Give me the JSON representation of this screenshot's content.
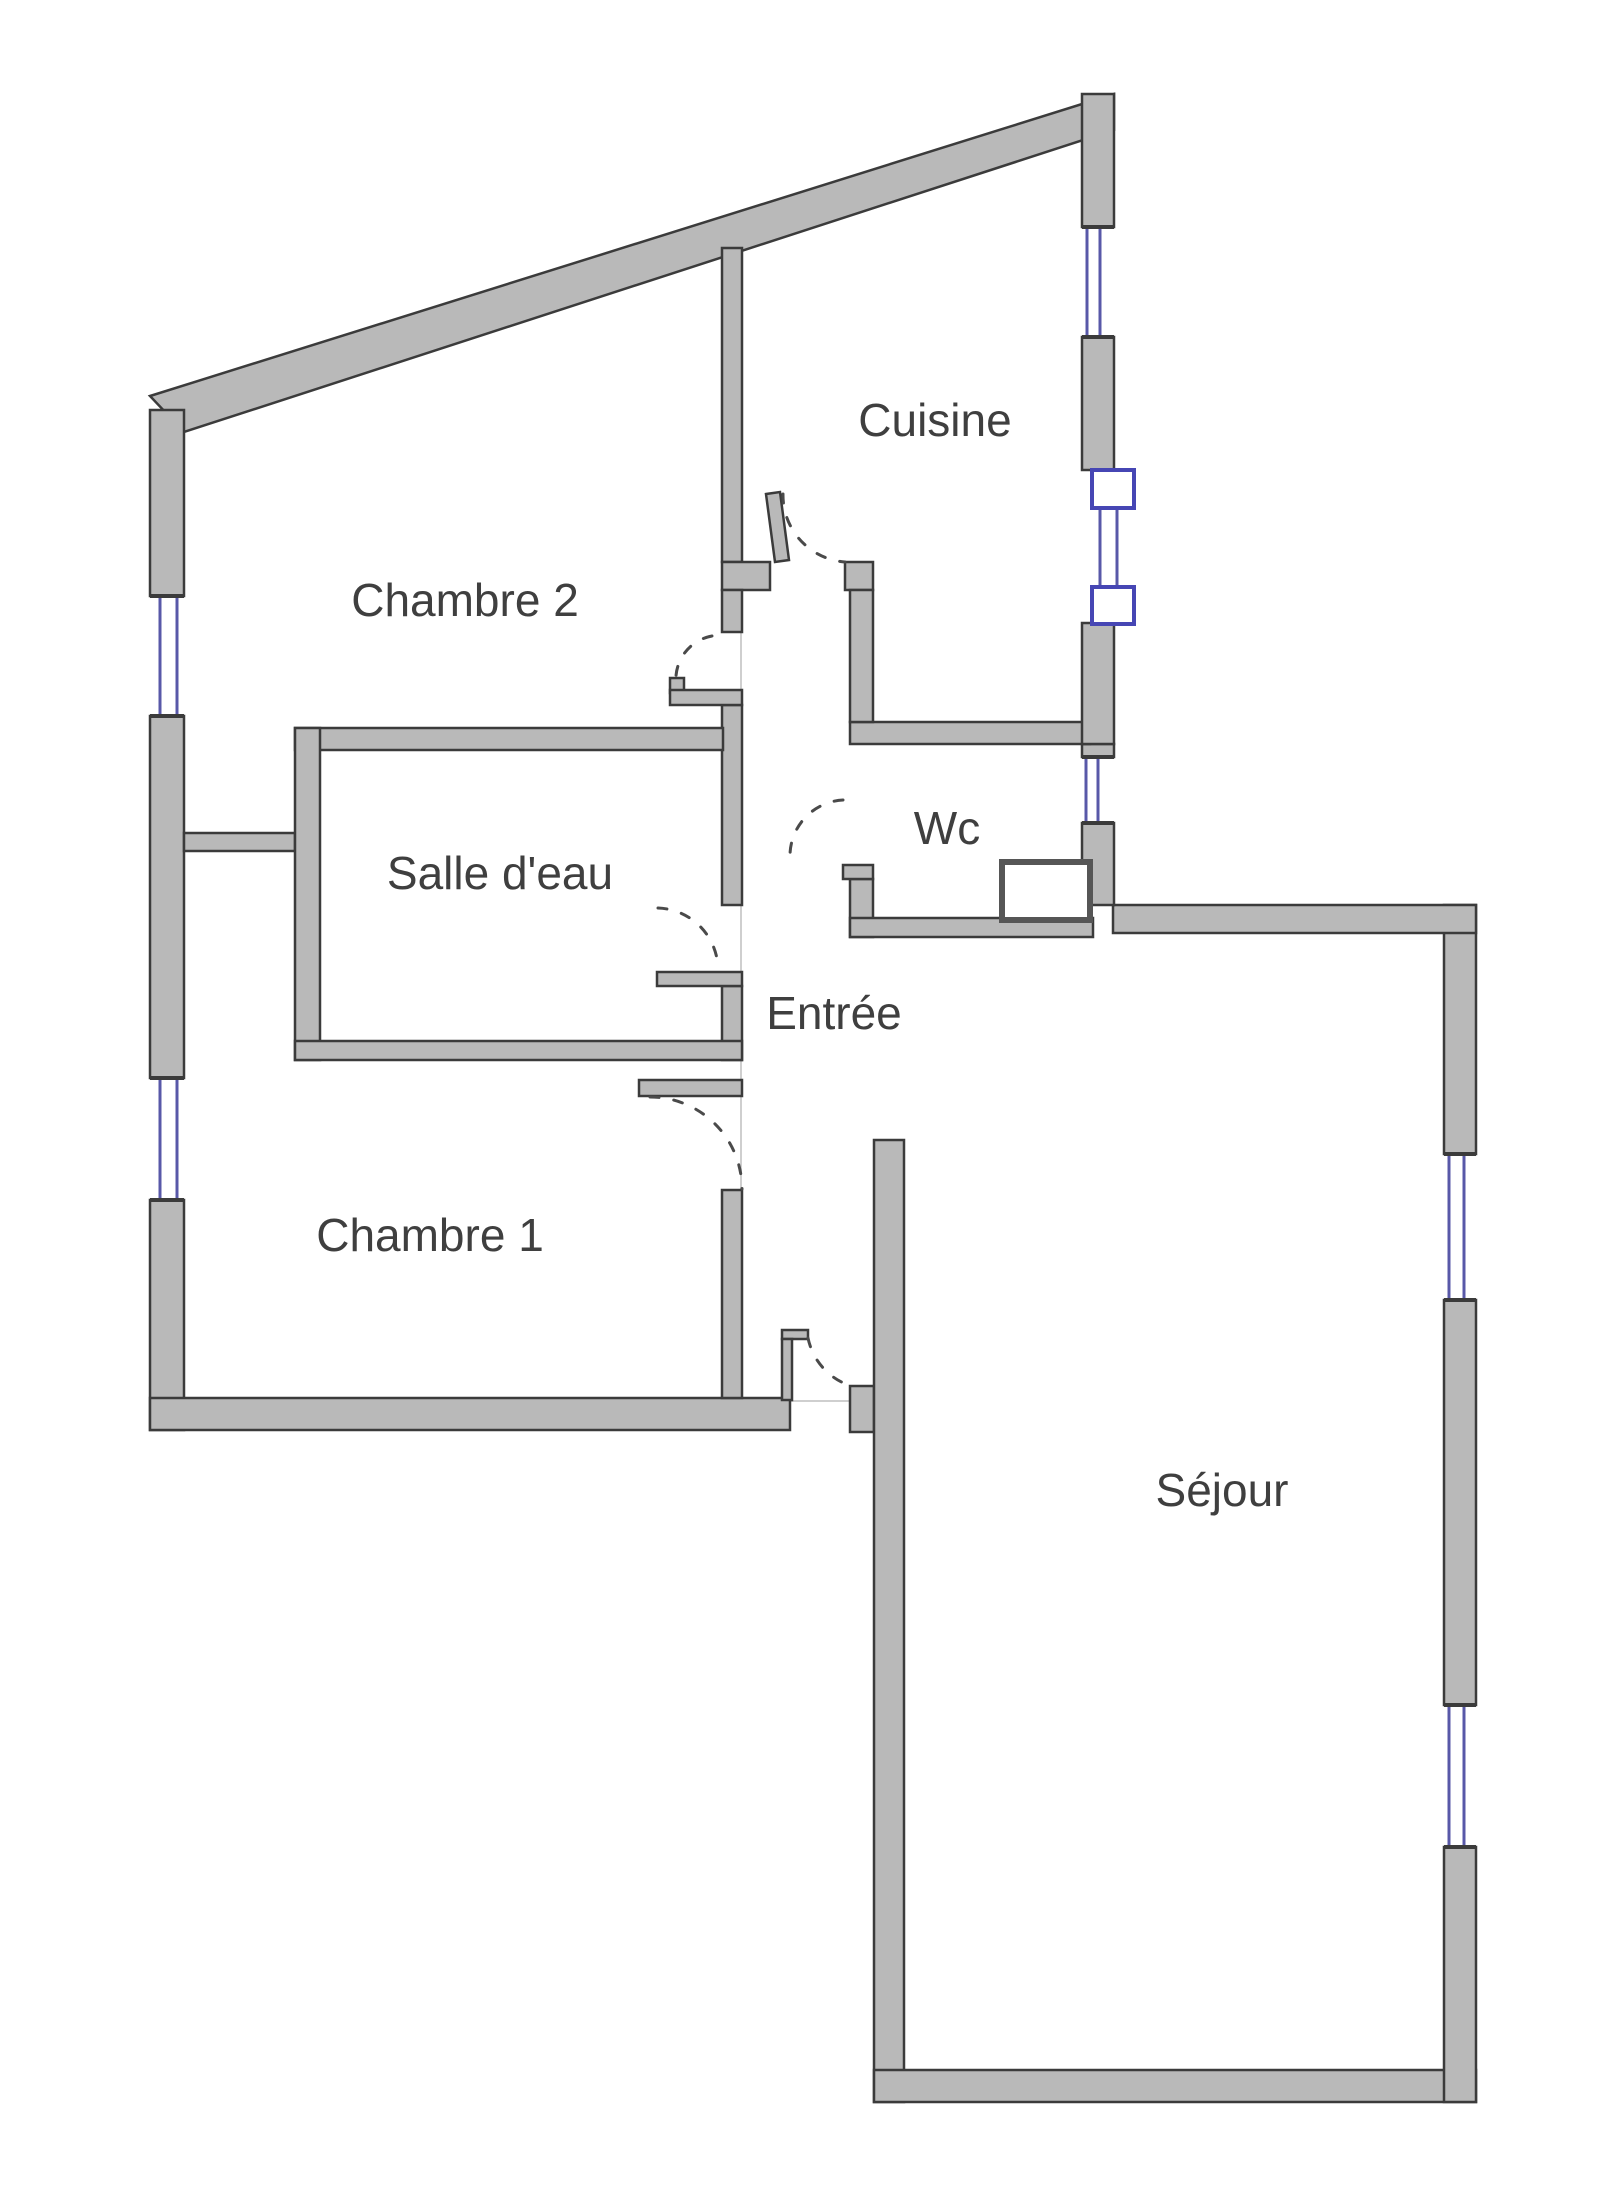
{
  "plan": {
    "width": 1600,
    "height": 2210,
    "kind": "apartment-floor-plan"
  },
  "colors": {
    "bg": "#ffffff",
    "wall_fill": "#b9b9b9",
    "wall_edge": "#3b3b3b",
    "window_blue": "#5858a8",
    "marker_blue": "#4646b4",
    "door_dash": "#4a4a4a",
    "face_line": "#cfcfcf",
    "label": "#3f3f3f"
  },
  "rooms": [
    {
      "id": "chambre2",
      "label": "Chambre 2",
      "x": 465,
      "y": 616
    },
    {
      "id": "cuisine",
      "label": "Cuisine",
      "x": 935,
      "y": 436
    },
    {
      "id": "salledeau",
      "label": "Salle d'eau",
      "x": 500,
      "y": 889
    },
    {
      "id": "wc",
      "label": "Wc",
      "x": 947,
      "y": 844
    },
    {
      "id": "entree",
      "label": "Entrée",
      "x": 834,
      "y": 1029
    },
    {
      "id": "chambre1",
      "label": "Chambre 1",
      "x": 430,
      "y": 1251
    },
    {
      "id": "sejour",
      "label": "Séjour",
      "x": 1222,
      "y": 1506
    }
  ],
  "geometry": {
    "walls_poly": [
      {
        "name": "top-diagonal-wall",
        "pts": "150,396 1114,94 1114,130 184,432"
      },
      {
        "name": "kitchen-door-leaf",
        "pts": "766,494 780,492 789,560 775,562"
      }
    ],
    "walls": [
      {
        "name": "left-wall-upper",
        "x": 150,
        "y": 410,
        "w": 34,
        "h": 186
      },
      {
        "name": "left-wall-mid",
        "x": 150,
        "y": 716,
        "w": 34,
        "h": 362
      },
      {
        "name": "left-wall-lower",
        "x": 150,
        "y": 1200,
        "w": 34,
        "h": 230
      },
      {
        "name": "chambre1-bottom-wall",
        "x": 150,
        "y": 1398,
        "w": 640,
        "h": 32
      },
      {
        "name": "entry-jog-wall",
        "x": 850,
        "y": 1386,
        "w": 24,
        "h": 46
      },
      {
        "name": "sejour-left-wall",
        "x": 874,
        "y": 1140,
        "w": 30,
        "h": 962
      },
      {
        "name": "sejour-bottom-wall",
        "x": 874,
        "y": 2070,
        "w": 602,
        "h": 32
      },
      {
        "name": "sejour-right-wall-lower",
        "x": 1444,
        "y": 1847,
        "w": 32,
        "h": 255
      },
      {
        "name": "sejour-right-wall-mid",
        "x": 1444,
        "y": 1300,
        "w": 32,
        "h": 405
      },
      {
        "name": "sejour-right-wall-upper",
        "x": 1444,
        "y": 905,
        "w": 32,
        "h": 249
      },
      {
        "name": "sejour-top-wall",
        "x": 1113,
        "y": 905,
        "w": 363,
        "h": 28
      },
      {
        "name": "east-wall-below-wc-window",
        "x": 1082,
        "y": 823,
        "w": 32,
        "h": 82
      },
      {
        "name": "east-wall-above-wc-window",
        "x": 1082,
        "y": 744,
        "w": 32,
        "h": 13
      },
      {
        "name": "wc-top-wall",
        "x": 850,
        "y": 722,
        "w": 240,
        "h": 22
      },
      {
        "name": "east-wall-cuisine-lower",
        "x": 1082,
        "y": 623,
        "w": 32,
        "h": 121
      },
      {
        "name": "east-wall-cuisine-mid",
        "x": 1082,
        "y": 337,
        "w": 32,
        "h": 133
      },
      {
        "name": "east-wall-peak",
        "x": 1082,
        "y": 94,
        "w": 32,
        "h": 133
      },
      {
        "name": "divider-chambre2-cuisine",
        "x": 722,
        "y": 248,
        "w": 20,
        "h": 314
      },
      {
        "name": "cuisine-bottom-wall-left",
        "x": 722,
        "y": 562,
        "w": 48,
        "h": 28
      },
      {
        "name": "cuisine-bottom-wall-right",
        "x": 845,
        "y": 562,
        "w": 28,
        "h": 28
      },
      {
        "name": "corridor-west-wall-a",
        "x": 722,
        "y": 590,
        "w": 20,
        "h": 42
      },
      {
        "name": "corridor-west-wall-b",
        "x": 722,
        "y": 705,
        "w": 20,
        "h": 200
      },
      {
        "name": "corridor-west-wall-c",
        "x": 722,
        "y": 986,
        "w": 20,
        "h": 74
      },
      {
        "name": "corridor-west-wall-d",
        "x": 722,
        "y": 1190,
        "w": 20,
        "h": 208
      },
      {
        "name": "chambre2-strip-wall",
        "x": 184,
        "y": 833,
        "w": 111,
        "h": 18
      },
      {
        "name": "salledeau-top-wall",
        "x": 295,
        "y": 728,
        "w": 428,
        "h": 22
      },
      {
        "name": "salledeau-left-wall",
        "x": 295,
        "y": 728,
        "w": 25,
        "h": 332
      },
      {
        "name": "salledeau-bottom-wall",
        "x": 295,
        "y": 1041,
        "w": 447,
        "h": 19
      },
      {
        "name": "wc-left-wall-upper",
        "x": 850,
        "y": 590,
        "w": 23,
        "h": 132
      },
      {
        "name": "wc-left-wall-lower",
        "x": 850,
        "y": 879,
        "w": 23,
        "h": 58
      },
      {
        "name": "wc-bottom-wall",
        "x": 850,
        "y": 918,
        "w": 243,
        "h": 19
      }
    ],
    "leaves": [
      {
        "name": "chambre2-door-stub-up",
        "x": 670,
        "y": 678,
        "w": 14,
        "h": 15
      },
      {
        "name": "chambre2-door-stub",
        "x": 670,
        "y": 690,
        "w": 72,
        "h": 15
      },
      {
        "name": "salledeau-door-leaf",
        "x": 657,
        "y": 972,
        "w": 85,
        "h": 14
      },
      {
        "name": "chambre1-door-leaf",
        "x": 639,
        "y": 1080,
        "w": 103,
        "h": 16
      },
      {
        "name": "wc-door-stub",
        "x": 843,
        "y": 865,
        "w": 30,
        "h": 14
      },
      {
        "name": "entry-door-leaf-cap",
        "x": 782,
        "y": 1330,
        "w": 26,
        "h": 9
      },
      {
        "name": "entry-door-leaf",
        "x": 782,
        "y": 1339,
        "w": 10,
        "h": 61
      }
    ],
    "duct": {
      "name": "wc-duct-box",
      "x": 1002,
      "y": 862,
      "w": 88,
      "h": 58
    },
    "windows": [
      {
        "name": "window-left-chambre2",
        "x": 150,
        "y": 596,
        "w": 34,
        "h": 120,
        "lx": [
          160,
          177
        ]
      },
      {
        "name": "window-left-chambre1",
        "x": 150,
        "y": 1078,
        "w": 34,
        "h": 122,
        "lx": [
          160,
          177
        ]
      },
      {
        "name": "window-cuisine-east",
        "x": 1082,
        "y": 227,
        "w": 32,
        "h": 110,
        "lx": [
          1087,
          1100
        ]
      },
      {
        "name": "window-wc-east",
        "x": 1082,
        "y": 757,
        "w": 32,
        "h": 66,
        "lx": [
          1086,
          1098
        ]
      },
      {
        "name": "window-sejour-upper",
        "x": 1444,
        "y": 1154,
        "w": 32,
        "h": 146,
        "lx": [
          1449,
          1464
        ]
      },
      {
        "name": "window-sejour-lower",
        "x": 1444,
        "y": 1705,
        "w": 32,
        "h": 142,
        "lx": [
          1449,
          1464
        ]
      }
    ],
    "marker": {
      "bg": {
        "x": 1086,
        "y": 508,
        "w": 34,
        "h": 79
      },
      "squares": [
        {
          "name": "cuisine-duct-square-top",
          "x": 1092,
          "y": 470,
          "w": 42,
          "h": 38
        },
        {
          "name": "cuisine-duct-square-bottom",
          "x": 1092,
          "y": 587,
          "w": 42,
          "h": 37
        }
      ],
      "lines": [
        {
          "x1": 1100,
          "y1": 508,
          "x2": 1100,
          "y2": 587
        },
        {
          "x1": 1117,
          "y1": 508,
          "x2": 1117,
          "y2": 587
        }
      ]
    },
    "arcs": [
      {
        "name": "kitchen-door-swing",
        "d": "M 783,494 A 67,67 0 0 0 845,562"
      },
      {
        "name": "chambre2-door-swing",
        "d": "M 712,636 A 44,44 0 0 0 676,676"
      },
      {
        "name": "salledeau-door-swing",
        "d": "M 658,908 A 62,62 0 0 1 718,970"
      },
      {
        "name": "chambre1-door-swing",
        "d": "M 650,1097 A 92,92 0 0 1 742,1189"
      },
      {
        "name": "entry-door-swing",
        "d": "M 808,1338 A 64,64 0 0 0 851,1386"
      },
      {
        "name": "wc-door-swing",
        "d": "M 843,800 A 56,56 0 0 0 790,855"
      }
    ],
    "lines": [
      {
        "name": "entry-threshold-line",
        "x1": 790,
        "y1": 1401,
        "x2": 850,
        "y2": 1401
      },
      {
        "name": "chambre2-opening-face",
        "x1": 741,
        "y1": 632,
        "x2": 741,
        "y2": 690
      },
      {
        "name": "salledeau-opening-face",
        "x1": 741,
        "y1": 905,
        "x2": 741,
        "y2": 972
      },
      {
        "name": "chambre1-opening-face",
        "x1": 741,
        "y1": 1060,
        "x2": 741,
        "y2": 1190
      }
    ]
  }
}
